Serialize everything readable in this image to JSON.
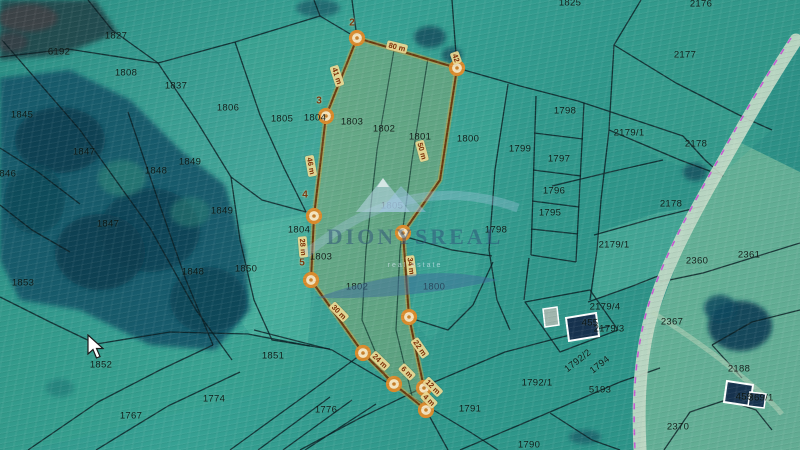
{
  "map": {
    "watermark": {
      "brand": "DIONYSREAL",
      "tagline": "real estate"
    },
    "colors": {
      "field_teal": "#2f9488",
      "forest_dark": "#17596a",
      "highlight_fill": "#b7b067",
      "highlight_outline": "#6b3a0e",
      "vertex_ring": "#d98a2b",
      "vertex_center": "#f3e3bd",
      "road_fill": "#c6dcc8",
      "road_line_magenta": "#c94fd4",
      "building_roof": "#16324e",
      "distance_chip": "#ecd994",
      "distance_text": "#7c2d06"
    },
    "parcel_labels": [
      {
        "t": "1827",
        "x": 116,
        "y": 36
      },
      {
        "t": "6192",
        "x": 59,
        "y": 52
      },
      {
        "t": "1808",
        "x": 126,
        "y": 73
      },
      {
        "t": "1837",
        "x": 176,
        "y": 86
      },
      {
        "t": "1806",
        "x": 228,
        "y": 108
      },
      {
        "t": "1845",
        "x": 22,
        "y": 115
      },
      {
        "t": "1847",
        "x": 84,
        "y": 152
      },
      {
        "t": "1846",
        "x": 5,
        "y": 174
      },
      {
        "t": "1849",
        "x": 190,
        "y": 162
      },
      {
        "t": "1848",
        "x": 156,
        "y": 171
      },
      {
        "t": "1849",
        "x": 222,
        "y": 211
      },
      {
        "t": "1847",
        "x": 108,
        "y": 224
      },
      {
        "t": "1853",
        "x": 23,
        "y": 283
      },
      {
        "t": "1848",
        "x": 193,
        "y": 272
      },
      {
        "t": "1850",
        "x": 246,
        "y": 269
      },
      {
        "t": "1852",
        "x": 101,
        "y": 365
      },
      {
        "t": "1767",
        "x": 131,
        "y": 416
      },
      {
        "t": "1774",
        "x": 214,
        "y": 399
      },
      {
        "t": "1851",
        "x": 273,
        "y": 356
      },
      {
        "t": "1776",
        "x": 326,
        "y": 410
      },
      {
        "t": "1791",
        "x": 470,
        "y": 409
      },
      {
        "t": "1792/1",
        "x": 537,
        "y": 383
      },
      {
        "t": "1790",
        "x": 529,
        "y": 445
      },
      {
        "t": "1805",
        "x": 282,
        "y": 119
      },
      {
        "t": "1804",
        "x": 315,
        "y": 118
      },
      {
        "t": "1803",
        "x": 352,
        "y": 122
      },
      {
        "t": "1802",
        "x": 384,
        "y": 129
      },
      {
        "t": "1801",
        "x": 420,
        "y": 137
      },
      {
        "t": "1800",
        "x": 468,
        "y": 139
      },
      {
        "t": "1804",
        "x": 299,
        "y": 230
      },
      {
        "t": "1803",
        "x": 321,
        "y": 257
      },
      {
        "t": "1802",
        "x": 357,
        "y": 287
      },
      {
        "t": "1800",
        "x": 434,
        "y": 287
      },
      {
        "t": "1805",
        "x": 392,
        "y": 206
      },
      {
        "t": "1798",
        "x": 565,
        "y": 111
      },
      {
        "t": "1799",
        "x": 520,
        "y": 149
      },
      {
        "t": "1797",
        "x": 559,
        "y": 159
      },
      {
        "t": "1796",
        "x": 554,
        "y": 191
      },
      {
        "t": "1795",
        "x": 550,
        "y": 213
      },
      {
        "t": "1798",
        "x": 496,
        "y": 230
      },
      {
        "t": "2179/1",
        "x": 629,
        "y": 133
      },
      {
        "t": "2177",
        "x": 685,
        "y": 55
      },
      {
        "t": "2176",
        "x": 701,
        "y": 4
      },
      {
        "t": "2178",
        "x": 696,
        "y": 144
      },
      {
        "t": "2178",
        "x": 671,
        "y": 204
      },
      {
        "t": "2179/1",
        "x": 614,
        "y": 245
      },
      {
        "t": "2360",
        "x": 697,
        "y": 261
      },
      {
        "t": "2361",
        "x": 749,
        "y": 255
      },
      {
        "t": "2367",
        "x": 672,
        "y": 322
      },
      {
        "t": "2179/4",
        "x": 605,
        "y": 307
      },
      {
        "t": "2179/3",
        "x": 609,
        "y": 329
      },
      {
        "t": "455",
        "x": 590,
        "y": 323
      },
      {
        "t": "1792/2",
        "x": 578,
        "y": 361,
        "rot": -38
      },
      {
        "t": "1794",
        "x": 600,
        "y": 365,
        "rot": -38
      },
      {
        "t": "5193",
        "x": 600,
        "y": 390
      },
      {
        "t": "2188",
        "x": 739,
        "y": 369
      },
      {
        "t": "459",
        "x": 744,
        "y": 397
      },
      {
        "t": "369/1",
        "x": 761,
        "y": 398
      },
      {
        "t": "2370",
        "x": 678,
        "y": 427
      },
      {
        "t": "1825",
        "x": 570,
        "y": 3
      }
    ],
    "highlight": {
      "polygon": "357,38 457,68 440,180 403,233 409,317 424,388 426,410 394,384 363,353 311,280 314,216 326,116",
      "inner_lines": [
        "M394,50 L377,150 L366,250 L362,320 L388,382",
        "M428,58 L412,160 L400,250 L396,330 L412,396"
      ],
      "vertices": [
        {
          "x": 357,
          "y": 38
        },
        {
          "x": 457,
          "y": 68
        },
        {
          "x": 326,
          "y": 116
        },
        {
          "x": 314,
          "y": 216
        },
        {
          "x": 311,
          "y": 280
        },
        {
          "x": 363,
          "y": 353
        },
        {
          "x": 394,
          "y": 384
        },
        {
          "x": 424,
          "y": 388
        },
        {
          "x": 426,
          "y": 410
        },
        {
          "x": 403,
          "y": 233
        },
        {
          "x": 409,
          "y": 317
        }
      ],
      "vertex_numbers": [
        {
          "t": "2",
          "x": 352,
          "y": 23
        },
        {
          "t": "3",
          "x": 319,
          "y": 101
        },
        {
          "t": "4",
          "x": 305,
          "y": 195
        },
        {
          "t": "5",
          "x": 302,
          "y": 263
        }
      ],
      "distance_labels": [
        {
          "t": "80 m",
          "x": 397,
          "y": 47,
          "rot": 14
        },
        {
          "t": "41 m",
          "x": 337,
          "y": 76,
          "rot": 72
        },
        {
          "t": "46 m",
          "x": 311,
          "y": 166,
          "rot": 80
        },
        {
          "t": "28 m",
          "x": 303,
          "y": 247,
          "rot": 85
        },
        {
          "t": "30 m",
          "x": 339,
          "y": 312,
          "rot": 46
        },
        {
          "t": "24 m",
          "x": 380,
          "y": 361,
          "rot": 44
        },
        {
          "t": "50 m",
          "x": 422,
          "y": 151,
          "rot": 75
        },
        {
          "t": "34 m",
          "x": 411,
          "y": 266,
          "rot": 83
        },
        {
          "t": "22 m",
          "x": 420,
          "y": 348,
          "rot": 55
        },
        {
          "t": "6 m",
          "x": 407,
          "y": 372,
          "rot": 45
        },
        {
          "t": "12 m",
          "x": 433,
          "y": 387,
          "rot": 45
        },
        {
          "t": "4 m",
          "x": 429,
          "y": 400,
          "rot": 45
        },
        {
          "t": "42",
          "x": 456,
          "y": 58,
          "rot": 70
        }
      ]
    },
    "regions": [
      {
        "points": "735,140 800,172 800,450 640,450 648,340 680,255 712,190",
        "fill": "#90c9a2",
        "opacity": 0.55
      },
      {
        "points": "598,232 660,212 700,207 658,278 592,300",
        "fill": "#5ebba4",
        "opacity": 0.45
      },
      {
        "points": "214,230 306,214 311,300 308,344 250,334 226,300",
        "fill": "#57bea6",
        "opacity": 0.4
      },
      {
        "points": "457,70 508,84 494,200 470,300 430,340 409,317 440,180",
        "fill": "#45b09a",
        "opacity": 0.3
      },
      {
        "points": "235,44 320,18 357,40 326,118 284,170 260,118",
        "fill": "#41a893",
        "opacity": 0.35
      },
      {
        "points": "614,45 676,83 745,118 772,130 716,180 660,158 609,130",
        "fill": "#3fa692",
        "opacity": 0.35
      },
      {
        "points": "0,297 96,344 250,335 310,346 290,385 150,420 28,450 0,450",
        "fill": "#37a18c",
        "opacity": 0.3
      },
      {
        "points": "641,0 800,0 800,40 735,140 676,83 614,45",
        "fill": "#3da18e",
        "opacity": 0.3
      },
      {
        "points": "432,383 505,352 562,337 640,326 648,340 640,450 448,450",
        "fill": "#2f9a8c",
        "opacity": 0.35
      }
    ],
    "forest": [
      {
        "points": "0,78 70,70 130,100 180,150 225,185 245,250 250,310 215,350 150,345 80,310 20,300 0,260",
        "fill": "#17596a",
        "opacity": 0.95
      },
      {
        "points": "0,0 95,0 118,33 60,55 0,60",
        "fill": "#24484e",
        "opacity": 0.95
      }
    ],
    "tree_blobs": [
      {
        "cx": 60,
        "cy": 140,
        "rx": 45,
        "ry": 33,
        "fill": "#0d3c50",
        "opacity": 0.85
      },
      {
        "cx": 150,
        "cy": 230,
        "rx": 50,
        "ry": 42,
        "fill": "#0e4255",
        "opacity": 0.85
      },
      {
        "cx": 208,
        "cy": 300,
        "rx": 38,
        "ry": 33,
        "fill": "#0f4456",
        "opacity": 0.85
      },
      {
        "cx": 100,
        "cy": 252,
        "rx": 45,
        "ry": 38,
        "fill": "#0d3d50",
        "opacity": 0.85
      },
      {
        "cx": 35,
        "cy": 200,
        "rx": 30,
        "ry": 34,
        "fill": "#114a58",
        "opacity": 0.8
      },
      {
        "cx": 122,
        "cy": 178,
        "rx": 24,
        "ry": 18,
        "fill": "#2e8577",
        "opacity": 0.6
      },
      {
        "cx": 190,
        "cy": 212,
        "rx": 20,
        "ry": 15,
        "fill": "#2b7f74",
        "opacity": 0.55
      },
      {
        "cx": 28,
        "cy": 18,
        "rx": 30,
        "ry": 14,
        "fill": "#474145",
        "opacity": 0.7
      },
      {
        "cx": 12,
        "cy": 42,
        "rx": 16,
        "ry": 10,
        "fill": "#3f3b42",
        "opacity": 0.6
      },
      {
        "cx": 318,
        "cy": 8,
        "rx": 22,
        "ry": 9,
        "fill": "#1d5f6b",
        "opacity": 0.8
      },
      {
        "cx": 430,
        "cy": 37,
        "rx": 16,
        "ry": 11,
        "fill": "#14505e",
        "opacity": 0.85
      },
      {
        "cx": 452,
        "cy": 55,
        "rx": 10,
        "ry": 8,
        "fill": "#14505e",
        "opacity": 0.8
      },
      {
        "cx": 695,
        "cy": 172,
        "rx": 12,
        "ry": 9,
        "fill": "#14505e",
        "opacity": 0.8
      },
      {
        "cx": 740,
        "cy": 326,
        "rx": 32,
        "ry": 25,
        "fill": "#0e3d54",
        "opacity": 0.9
      },
      {
        "cx": 720,
        "cy": 308,
        "rx": 16,
        "ry": 13,
        "fill": "#114a5e",
        "opacity": 0.85
      },
      {
        "cx": 585,
        "cy": 437,
        "rx": 16,
        "ry": 7,
        "fill": "#135060",
        "opacity": 0.6
      },
      {
        "cx": 60,
        "cy": 388,
        "rx": 14,
        "ry": 9,
        "fill": "#186a6e",
        "opacity": 0.45
      }
    ],
    "boundaries": [
      "M88,0 L112,30 L158,63",
      "M0,57 L68,49 L158,63",
      "M158,63 L235,42 L320,16 L357,38",
      "M320,16 L314,0",
      "M352,0 L357,38",
      "M2,40 L80,130 L150,228 L196,310 L232,360",
      "M158,63 L196,120 L231,177",
      "M231,177 L262,200 L306,212",
      "M231,177 L240,240 L254,300 L272,340 L310,346",
      "M128,112 L158,200 L186,280 L213,345",
      "M235,42 L260,115 L284,168 L306,212",
      "M0,148 L38,172 L80,204",
      "M0,205 L32,230 L70,252",
      "M0,297 L50,322 L96,344",
      "M96,344 L170,332 L248,334 L310,346",
      "M28,450 L98,402 L160,370 L213,345",
      "M96,450 L168,406 L240,372",
      "M230,450 L310,392 L363,353",
      "M258,450 L330,397",
      "M283,450 L352,400",
      "M305,450 L376,404",
      "M254,330 L332,350 L400,390 L470,432 L498,450",
      "M300,450 L360,418 L432,383 L505,352 L562,337 L610,326",
      "M426,410 L448,450",
      "M460,450 L550,412 L620,382 L660,368",
      "M457,68 L520,86 L578,101 L641,122 L683,136",
      "M536,96 L531,255",
      "M584,103 L576,262",
      "M534,133 L583,139",
      "M533,170 L581,176",
      "M532,201 L579,207",
      "M531,229 L578,234",
      "M531,255 L576,262",
      "M529,258 L524,300",
      "M508,84 L495,170 L489,250 L497,300 L510,330",
      "M641,0 L614,45 L609,130 L601,200 L597,250 L590,300",
      "M614,45 L676,83 L745,118 L772,130",
      "M609,130 L680,160 L723,176",
      "M552,186 L610,172 L663,160",
      "M594,235 L655,218 L700,207",
      "M588,302 L630,287 L658,276",
      "M525,302 L590,290 L618,330 L560,352 Z",
      "M660,282 L703,273 L800,243",
      "M800,310 L752,322 L712,345",
      "M712,345 L742,378",
      "M664,450 L690,412 L726,400 L756,410 L772,430",
      "M493,262 L473,305 L448,330 L410,318",
      "M406,237 L452,250 L492,256",
      "M452,0 L457,68",
      "M550,413 L592,440 L620,450",
      "M310,346 L330,349",
      "M683,136 L705,160 L723,176"
    ],
    "road": {
      "path": "M796,40 C760,95 737,138 714,178 C688,224 664,270 652,312 C642,348 637,390 640,450",
      "magenta_path": "M791,38 C755,93 732,136 709,176 C683,222 659,268 647,310 C637,346 632,388 635,450",
      "track_path": "M652,312 C680,330 710,350 736,372 C756,388 770,400 782,414"
    },
    "buildings": [
      {
        "points": "566,318 596,313 599,336 569,341",
        "fill": "#16324e",
        "stroke": "#ffffff",
        "sw": 2
      },
      {
        "points": "543,309 557,307 559,325 545,327",
        "fill": "#9fb5ad",
        "stroke": "#ffffff",
        "sw": 1.5
      },
      {
        "points": "727,381 753,385 750,406 724,402",
        "fill": "#16324e",
        "stroke": "#ffffff",
        "sw": 2
      },
      {
        "points": "750,392 766,394 764,408 748,406",
        "fill": "#16324e",
        "stroke": "#ffffff",
        "sw": 1.5
      }
    ],
    "cursor": {
      "x": 86,
      "y": 334
    }
  }
}
